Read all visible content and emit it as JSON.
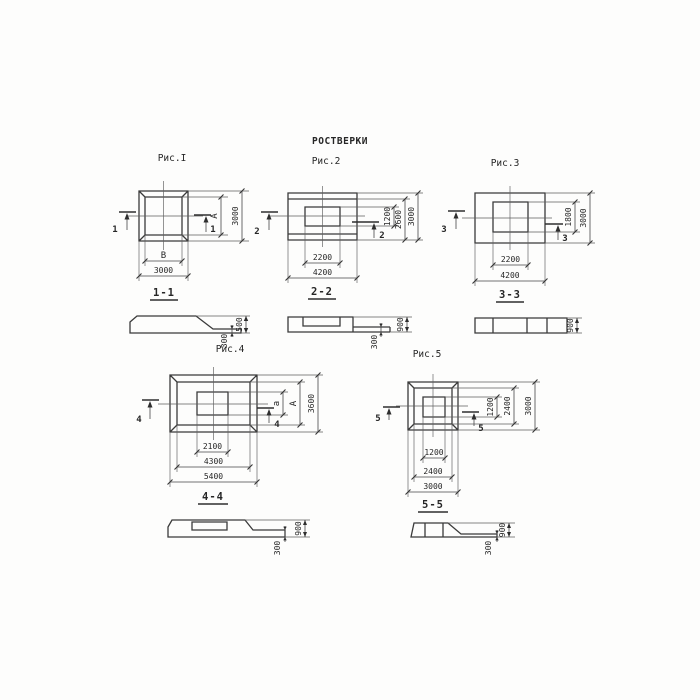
{
  "title": "РОСТВЕРКИ",
  "figures": [
    {
      "label": "Рис.I",
      "cut": "1",
      "section_title": "1-1",
      "dims": {
        "right": [
          "А",
          "3000"
        ],
        "bottom": [
          "В",
          "3000"
        ]
      }
    },
    {
      "label": "Рис.2",
      "cut": "2",
      "section_title": "2-2",
      "dims": {
        "right": [
          "1200",
          "2600",
          "3000"
        ],
        "bottom": [
          "2200",
          "4200"
        ]
      }
    },
    {
      "label": "Рис.3",
      "cut": "3",
      "section_title": "3-3",
      "dims": {
        "right": [
          "1800",
          "3000"
        ],
        "bottom": [
          "2200",
          "4200"
        ]
      }
    },
    {
      "label": "Рис.4",
      "cut": "4",
      "section_title": "4-4",
      "dims": {
        "right": [
          "а",
          "А",
          "3600"
        ],
        "bottom": [
          "2100",
          "4300",
          "5400"
        ]
      }
    },
    {
      "label": "Рис.5",
      "cut": "5",
      "section_title": "5-5",
      "dims": {
        "right": [
          "1200",
          "2400",
          "3000"
        ],
        "bottom": [
          "1200",
          "2400",
          "3000"
        ]
      }
    }
  ],
  "sections": [
    {
      "height": "500",
      "step": "300"
    },
    {
      "height": "900",
      "step": "300"
    },
    {
      "height": "900"
    },
    {
      "height": "900",
      "step": "300"
    },
    {
      "height": "900",
      "step": "300"
    }
  ]
}
